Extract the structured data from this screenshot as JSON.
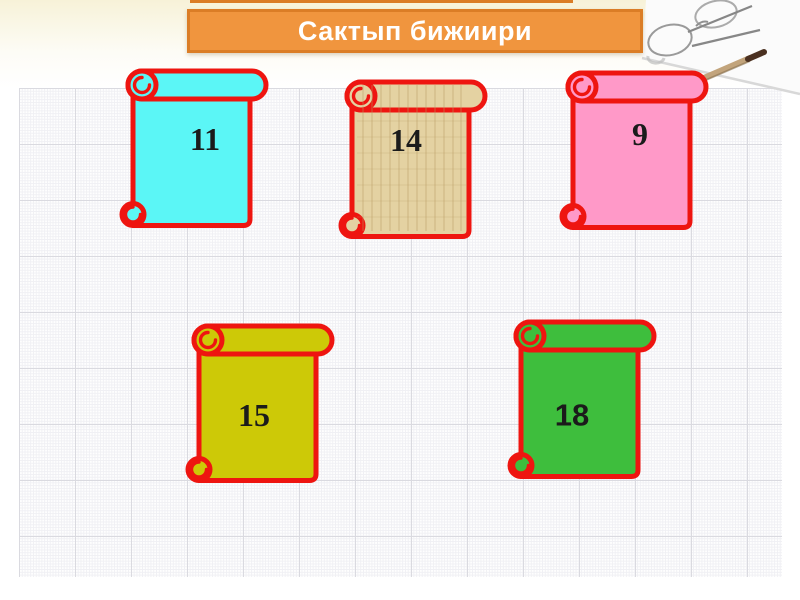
{
  "slide": {
    "title": "Сактып бижиири"
  },
  "scrolls": [
    {
      "number": "11",
      "color": "#5BF6F6"
    },
    {
      "number": "14",
      "color": "#E4D2A2"
    },
    {
      "number": "9",
      "color": "#FF99C8"
    },
    {
      "number": "15",
      "color": "#CDC907"
    },
    {
      "number": "18",
      "color": "#3EBE3D"
    }
  ],
  "decor": {
    "background": "graph-paper-grid",
    "corner_image": "glasses-and-pencil-on-paper"
  },
  "colors": {
    "scroll_border": "#EE1510",
    "number_color": "#1B1B1B",
    "banner_fill": "#F0953E",
    "banner_border": "#DB7D26",
    "banner_text": "#FFFFFF",
    "grid_major": "#DADAE0",
    "grid_fine": "#F0F0F4",
    "cream_top": "#F7F2D8"
  }
}
